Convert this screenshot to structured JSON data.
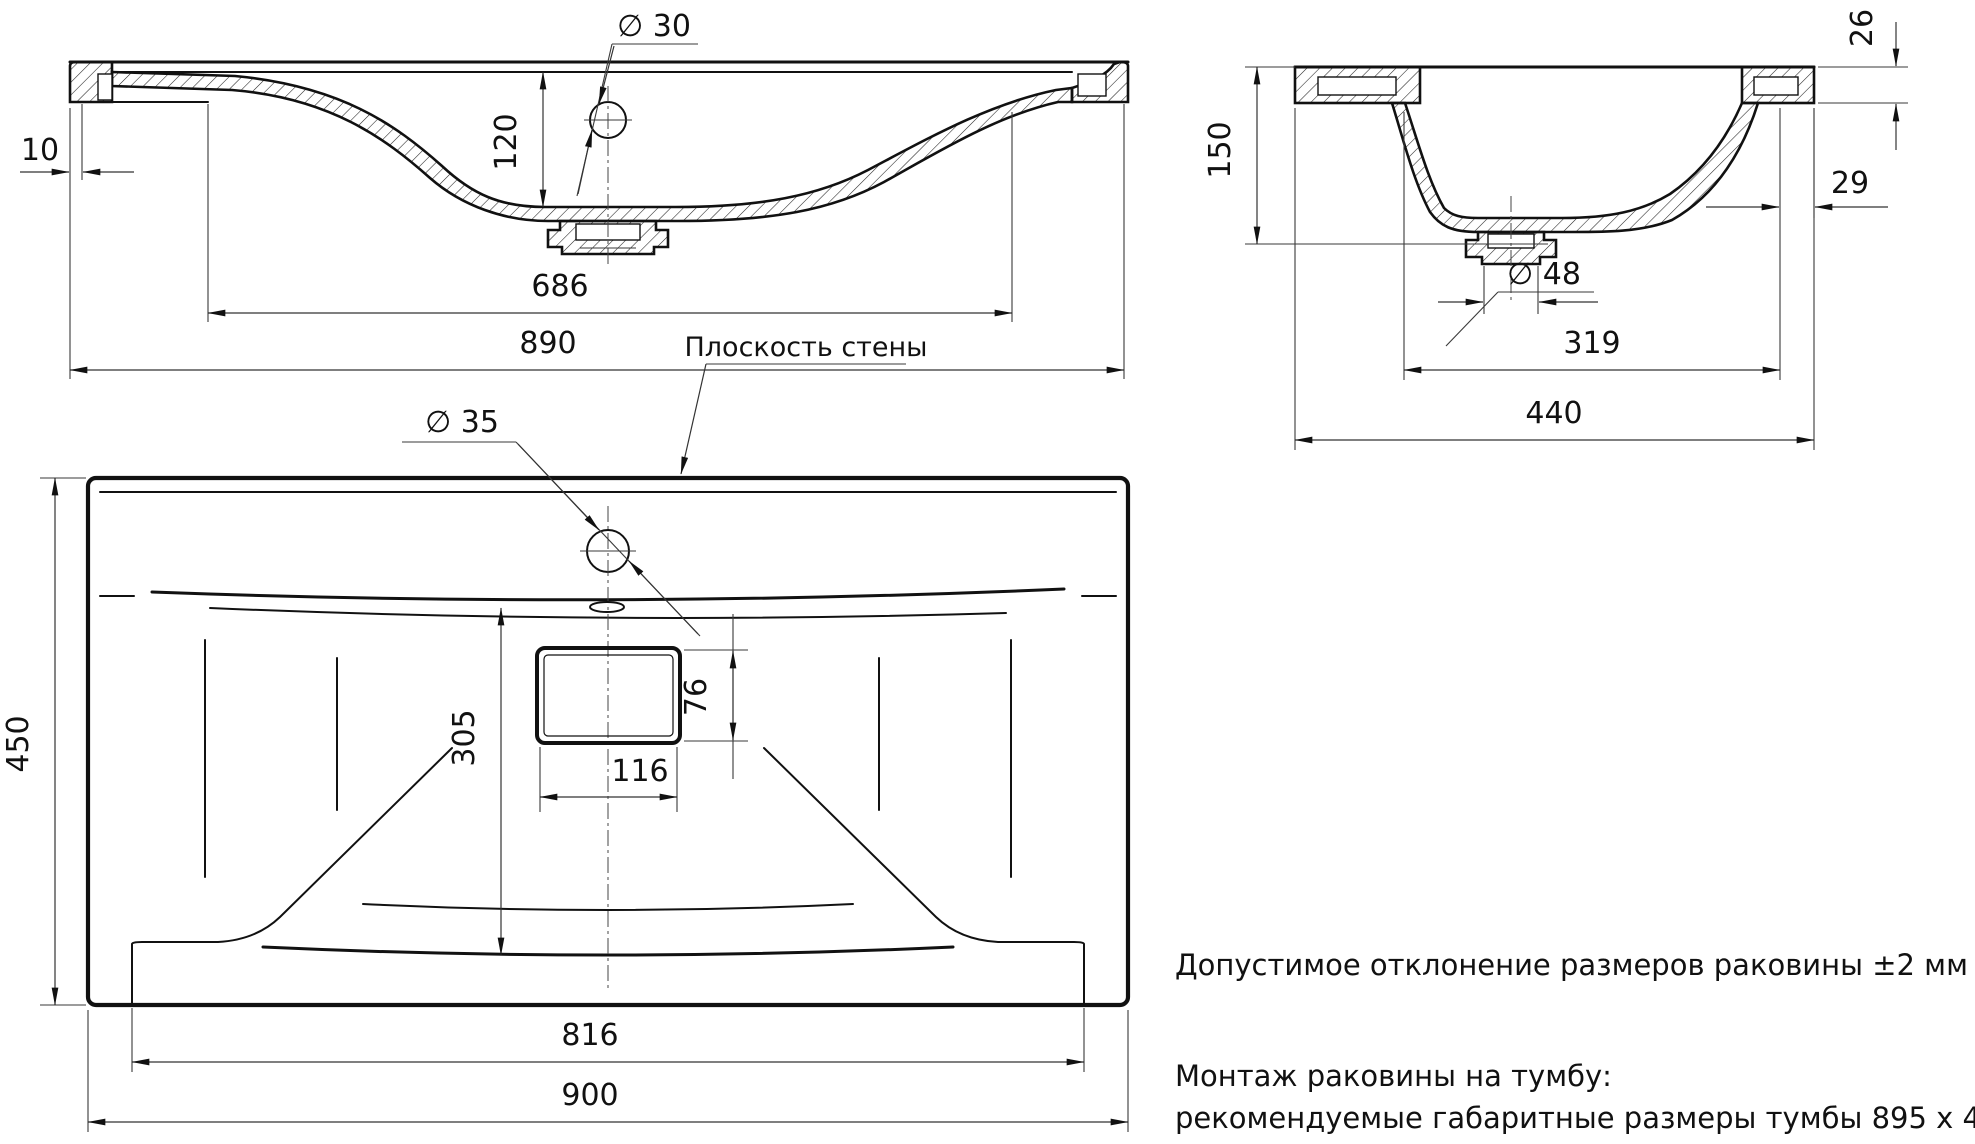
{
  "front": {
    "offset": "10",
    "height": "120",
    "hole": "∅ 30",
    "basin_width": "686",
    "width": "890"
  },
  "side": {
    "apron": "26",
    "depth": "150",
    "edge": "29",
    "drain": "∅ 48",
    "basin_width": "319",
    "width": "440"
  },
  "plan": {
    "wall_plane": "Плоскость стены",
    "hole": "∅ 35",
    "drain_offset": "305",
    "drain_height": "76",
    "drain_width": "116",
    "depth": "450",
    "basin_width": "816",
    "width": "900"
  },
  "notes": {
    "tolerance": "Допустимое отклонение размеров раковины ±2 мм",
    "mount_title": "Монтаж раковины на тумбу:",
    "mount_detail": "рекомендуемые габаритные размеры тумбы 895 х 445 мм"
  }
}
